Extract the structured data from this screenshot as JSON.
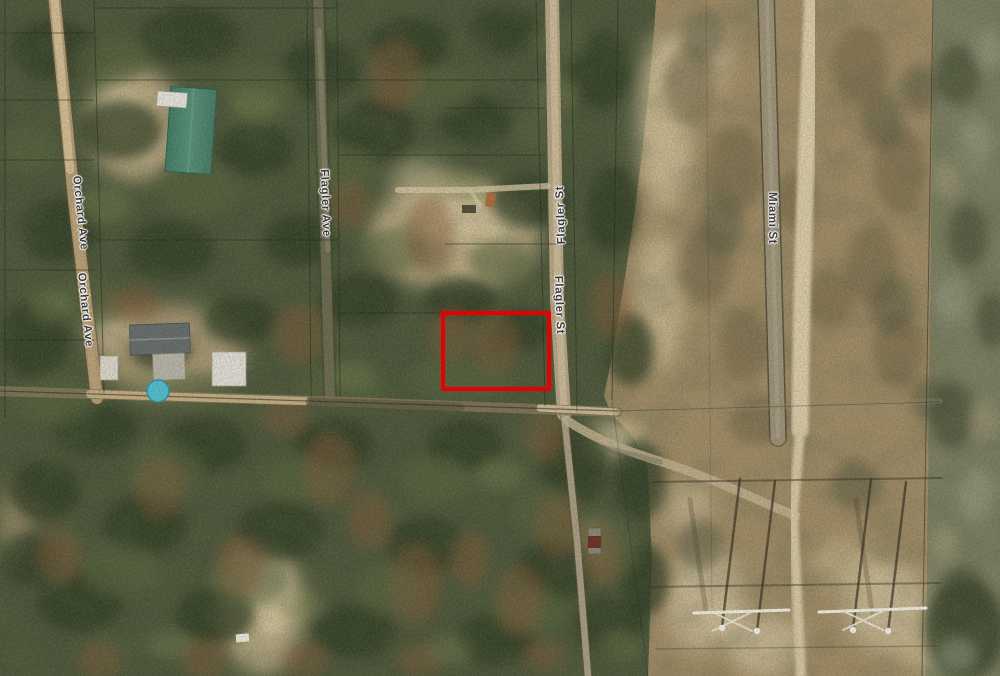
{
  "map": {
    "imagery": "aerial-satellite",
    "streets": {
      "orchard_ave": {
        "label": "Orchard Ave"
      },
      "flagler_ave": {
        "label": "Flagler Ave"
      },
      "flagler_st": {
        "label": "Flagler St"
      },
      "miami_st": {
        "label": "Miami St"
      }
    },
    "highlight": {
      "color": "#e60000",
      "x": 443,
      "y": 313,
      "width": 106,
      "height": 76
    }
  }
}
